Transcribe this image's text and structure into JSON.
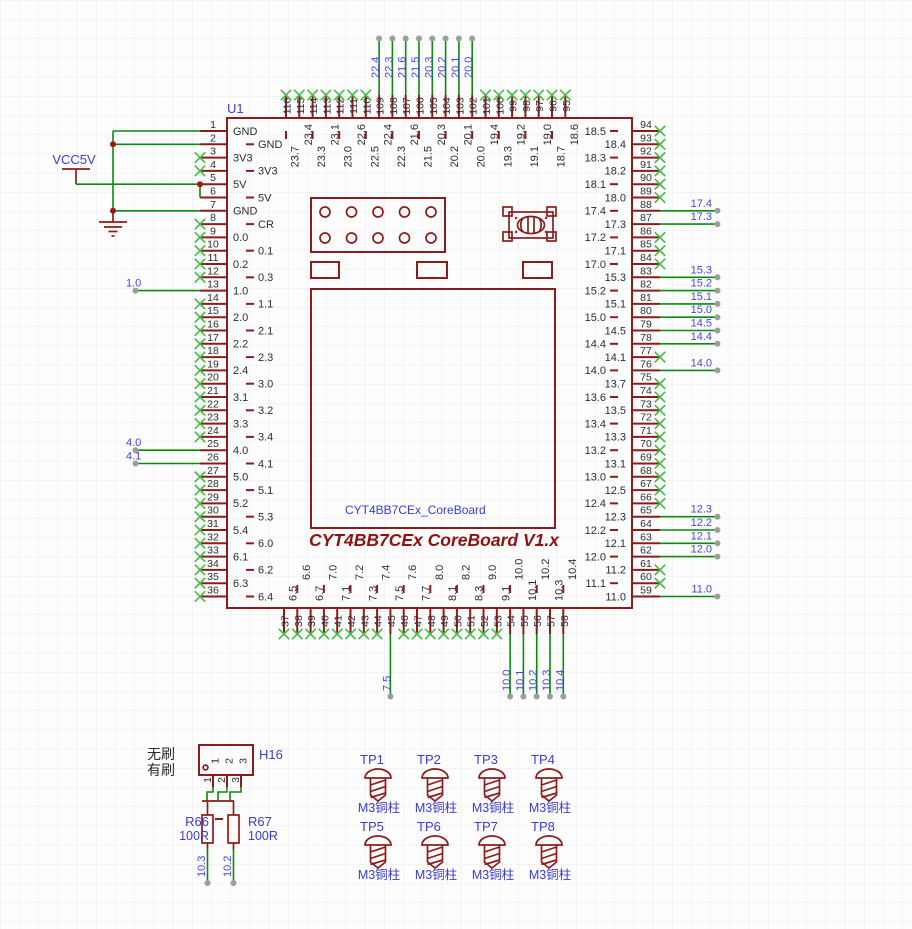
{
  "colors": {
    "outline": "#8c1c1c",
    "wire": "#0b8a0b",
    "no_connect": "#49bd49",
    "net_text": "#4545e0",
    "ref_text": "#3b3bd4",
    "pin_text": "#2d2d2d",
    "title": "#8e1212",
    "grid": "#e9e9e9",
    "background": "#fdfdfd"
  },
  "power": {
    "vcc": "VCC5V"
  },
  "labels": {
    "brushless": "无刷",
    "brushed": "有刷"
  },
  "chip": {
    "ref": "U1",
    "inner_label": "CYT4BB7CEx_CoreBoard",
    "title": "CYT4BB7CEx CoreBoard V1.x",
    "pins": {
      "left": [
        {
          "n": "1",
          "name": "GND",
          "c": "r"
        },
        {
          "n": "2",
          "name": "GND",
          "c": "r"
        },
        {
          "n": "3",
          "name": "3V3",
          "c": "x"
        },
        {
          "n": "4",
          "name": "3V3",
          "c": "x"
        },
        {
          "n": "5",
          "name": "5V",
          "c": "r"
        },
        {
          "n": "6",
          "name": "5V",
          "c": "r"
        },
        {
          "n": "7",
          "name": "GND",
          "c": "r"
        },
        {
          "n": "8",
          "name": "CR",
          "c": "x"
        },
        {
          "n": "9",
          "name": "0.0",
          "c": "x"
        },
        {
          "n": "10",
          "name": "0.1",
          "c": "x"
        },
        {
          "n": "11",
          "name": "0.2",
          "c": "x"
        },
        {
          "n": "12",
          "name": "0.3",
          "c": "x"
        },
        {
          "n": "13",
          "name": "1.0",
          "c": "n"
        },
        {
          "n": "14",
          "name": "1.1",
          "c": "x"
        },
        {
          "n": "15",
          "name": "2.0",
          "c": "x"
        },
        {
          "n": "16",
          "name": "2.1",
          "c": "x"
        },
        {
          "n": "17",
          "name": "2.2",
          "c": "x"
        },
        {
          "n": "18",
          "name": "2.3",
          "c": "x"
        },
        {
          "n": "19",
          "name": "2.4",
          "c": "x"
        },
        {
          "n": "20",
          "name": "3.0",
          "c": "x"
        },
        {
          "n": "21",
          "name": "3.1",
          "c": "x"
        },
        {
          "n": "22",
          "name": "3.2",
          "c": "x"
        },
        {
          "n": "23",
          "name": "3.3",
          "c": "x"
        },
        {
          "n": "24",
          "name": "3.4",
          "c": "x"
        },
        {
          "n": "25",
          "name": "4.0",
          "c": "n"
        },
        {
          "n": "26",
          "name": "4.1",
          "c": "n"
        },
        {
          "n": "27",
          "name": "5.0",
          "c": "x"
        },
        {
          "n": "28",
          "name": "5.1",
          "c": "x"
        },
        {
          "n": "29",
          "name": "5.2",
          "c": "x"
        },
        {
          "n": "30",
          "name": "5.3",
          "c": "x"
        },
        {
          "n": "31",
          "name": "5.4",
          "c": "x"
        },
        {
          "n": "32",
          "name": "6.0",
          "c": "x"
        },
        {
          "n": "33",
          "name": "6.1",
          "c": "x"
        },
        {
          "n": "34",
          "name": "6.2",
          "c": "x"
        },
        {
          "n": "35",
          "name": "6.3",
          "c": "x"
        },
        {
          "n": "36",
          "name": "6.4",
          "c": "x"
        }
      ],
      "top": [
        {
          "n": "116",
          "name": "23.7",
          "c": "x"
        },
        {
          "n": "115",
          "name": "23.4",
          "c": "x"
        },
        {
          "n": "114",
          "name": "23.3",
          "c": "x"
        },
        {
          "n": "113",
          "name": "23.1",
          "c": "x"
        },
        {
          "n": "112",
          "name": "23.0",
          "c": "x"
        },
        {
          "n": "111",
          "name": "22.6",
          "c": "x"
        },
        {
          "n": "110",
          "name": "22.5",
          "c": "x"
        },
        {
          "n": "109",
          "name": "22.4",
          "c": "n"
        },
        {
          "n": "108",
          "name": "22.3",
          "c": "n"
        },
        {
          "n": "107",
          "name": "21.6",
          "c": "n"
        },
        {
          "n": "106",
          "name": "21.5",
          "c": "n"
        },
        {
          "n": "105",
          "name": "20.3",
          "c": "n"
        },
        {
          "n": "104",
          "name": "20.2",
          "c": "n"
        },
        {
          "n": "103",
          "name": "20.1",
          "c": "n"
        },
        {
          "n": "102",
          "name": "20.0",
          "c": "n"
        },
        {
          "n": "101",
          "name": "19.4",
          "c": "x"
        },
        {
          "n": "100",
          "name": "19.3",
          "c": "x"
        },
        {
          "n": "99",
          "name": "19.2",
          "c": "x"
        },
        {
          "n": "98",
          "name": "19.1",
          "c": "x"
        },
        {
          "n": "97",
          "name": "19.0",
          "c": "x"
        },
        {
          "n": "96",
          "name": "18.7",
          "c": "x"
        },
        {
          "n": "95",
          "name": "18.6",
          "c": "x"
        }
      ],
      "right": [
        {
          "n": "94",
          "name": "18.5",
          "c": "x"
        },
        {
          "n": "93",
          "name": "18.4",
          "c": "x"
        },
        {
          "n": "92",
          "name": "18.3",
          "c": "x"
        },
        {
          "n": "91",
          "name": "18.2",
          "c": "x"
        },
        {
          "n": "90",
          "name": "18.1",
          "c": "x"
        },
        {
          "n": "89",
          "name": "18.0",
          "c": "x"
        },
        {
          "n": "88",
          "name": "17.4",
          "c": "n"
        },
        {
          "n": "87",
          "name": "17.3",
          "c": "n"
        },
        {
          "n": "86",
          "name": "17.2",
          "c": "x"
        },
        {
          "n": "85",
          "name": "17.1",
          "c": "x"
        },
        {
          "n": "84",
          "name": "17.0",
          "c": "x"
        },
        {
          "n": "83",
          "name": "15.3",
          "c": "n"
        },
        {
          "n": "82",
          "name": "15.2",
          "c": "n"
        },
        {
          "n": "81",
          "name": "15.1",
          "c": "n"
        },
        {
          "n": "80",
          "name": "15.0",
          "c": "n"
        },
        {
          "n": "79",
          "name": "14.5",
          "c": "n"
        },
        {
          "n": "78",
          "name": "14.4",
          "c": "n"
        },
        {
          "n": "77",
          "name": "14.1",
          "c": "x"
        },
        {
          "n": "76",
          "name": "14.0",
          "c": "n"
        },
        {
          "n": "75",
          "name": "13.7",
          "c": "x"
        },
        {
          "n": "74",
          "name": "13.6",
          "c": "x"
        },
        {
          "n": "73",
          "name": "13.5",
          "c": "x"
        },
        {
          "n": "72",
          "name": "13.4",
          "c": "x"
        },
        {
          "n": "71",
          "name": "13.3",
          "c": "x"
        },
        {
          "n": "70",
          "name": "13.2",
          "c": "x"
        },
        {
          "n": "69",
          "name": "13.1",
          "c": "x"
        },
        {
          "n": "68",
          "name": "13.0",
          "c": "x"
        },
        {
          "n": "67",
          "name": "12.5",
          "c": "x"
        },
        {
          "n": "66",
          "name": "12.4",
          "c": "x"
        },
        {
          "n": "65",
          "name": "12.3",
          "c": "n"
        },
        {
          "n": "64",
          "name": "12.2",
          "c": "n"
        },
        {
          "n": "63",
          "name": "12.1",
          "c": "n"
        },
        {
          "n": "62",
          "name": "12.0",
          "c": "n"
        },
        {
          "n": "61",
          "name": "11.2",
          "c": "x"
        },
        {
          "n": "60",
          "name": "11.1",
          "c": "x"
        },
        {
          "n": "59",
          "name": "11.0",
          "c": "n"
        }
      ],
      "bottom": [
        {
          "n": "37",
          "name": "6.5",
          "c": "x"
        },
        {
          "n": "38",
          "name": "6.6",
          "c": "x"
        },
        {
          "n": "39",
          "name": "6.7",
          "c": "x"
        },
        {
          "n": "40",
          "name": "7.0",
          "c": "x"
        },
        {
          "n": "41",
          "name": "7.1",
          "c": "x"
        },
        {
          "n": "42",
          "name": "7.2",
          "c": "x"
        },
        {
          "n": "43",
          "name": "7.3",
          "c": "x"
        },
        {
          "n": "44",
          "name": "7.4",
          "c": "x"
        },
        {
          "n": "45",
          "name": "7.5",
          "c": "n"
        },
        {
          "n": "46",
          "name": "7.6",
          "c": "x"
        },
        {
          "n": "47",
          "name": "7.7",
          "c": "x"
        },
        {
          "n": "48",
          "name": "8.0",
          "c": "x"
        },
        {
          "n": "49",
          "name": "8.1",
          "c": "x"
        },
        {
          "n": "50",
          "name": "8.2",
          "c": "x"
        },
        {
          "n": "51",
          "name": "8.3",
          "c": "x"
        },
        {
          "n": "52",
          "name": "9.0",
          "c": "x"
        },
        {
          "n": "53",
          "name": "9.1",
          "c": "x"
        },
        {
          "n": "54",
          "name": "10.0",
          "c": "n"
        },
        {
          "n": "55",
          "name": "10.1",
          "c": "n"
        },
        {
          "n": "56",
          "name": "10.2",
          "c": "n"
        },
        {
          "n": "57",
          "name": "10.3",
          "c": "n"
        },
        {
          "n": "58",
          "name": "10.4",
          "c": "n"
        }
      ]
    }
  },
  "connector": {
    "ref": "H16",
    "pin_names": [
      "1",
      "2",
      "3"
    ],
    "pin_numbers": [
      "1",
      "2",
      "3"
    ]
  },
  "resistors": [
    {
      "ref": "R66",
      "value": "100R",
      "net": "10.3"
    },
    {
      "ref": "R67",
      "value": "100R",
      "net": "10.2"
    }
  ],
  "testpoints": [
    {
      "ref": "TP1",
      "value": "M3铜柱"
    },
    {
      "ref": "TP2",
      "value": "M3铜柱"
    },
    {
      "ref": "TP3",
      "value": "M3铜柱"
    },
    {
      "ref": "TP4",
      "value": "M3铜柱"
    },
    {
      "ref": "TP5",
      "value": "M3铜柱"
    },
    {
      "ref": "TP6",
      "value": "M3铜柱"
    },
    {
      "ref": "TP7",
      "value": "M3铜柱"
    },
    {
      "ref": "TP8",
      "value": "M3铜柱"
    }
  ]
}
